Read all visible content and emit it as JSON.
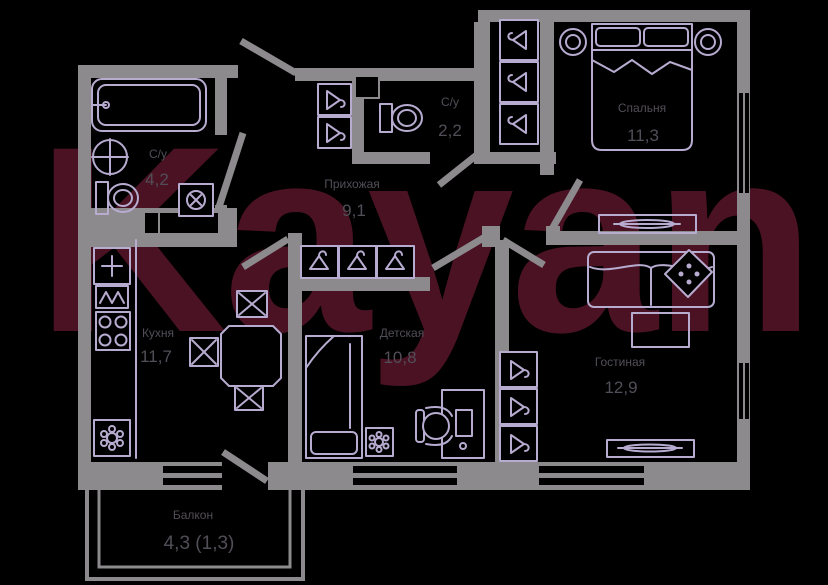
{
  "watermark": "Kayan",
  "rooms": {
    "bathroom": {
      "name": "С/у",
      "area": "4,2"
    },
    "toilet": {
      "name": "С/у",
      "area": "2,2"
    },
    "hallway": {
      "name": "Прихожая",
      "area": "9,1"
    },
    "bedroom": {
      "name": "Спальня",
      "area": "11,3"
    },
    "kitchen": {
      "name": "Кухня",
      "area": "11,7"
    },
    "children": {
      "name": "Детская",
      "area": "10,8"
    },
    "living": {
      "name": "Гостиная",
      "area": "12,9"
    },
    "balcony": {
      "name": "Балкон",
      "area": "4,3 (1,3)"
    }
  },
  "colors": {
    "background": "#000000",
    "walls": "#8d8a8d",
    "furniture": "#b7abd0",
    "labels": "#524e58",
    "watermark": "#4a1223",
    "window": "#000000"
  }
}
